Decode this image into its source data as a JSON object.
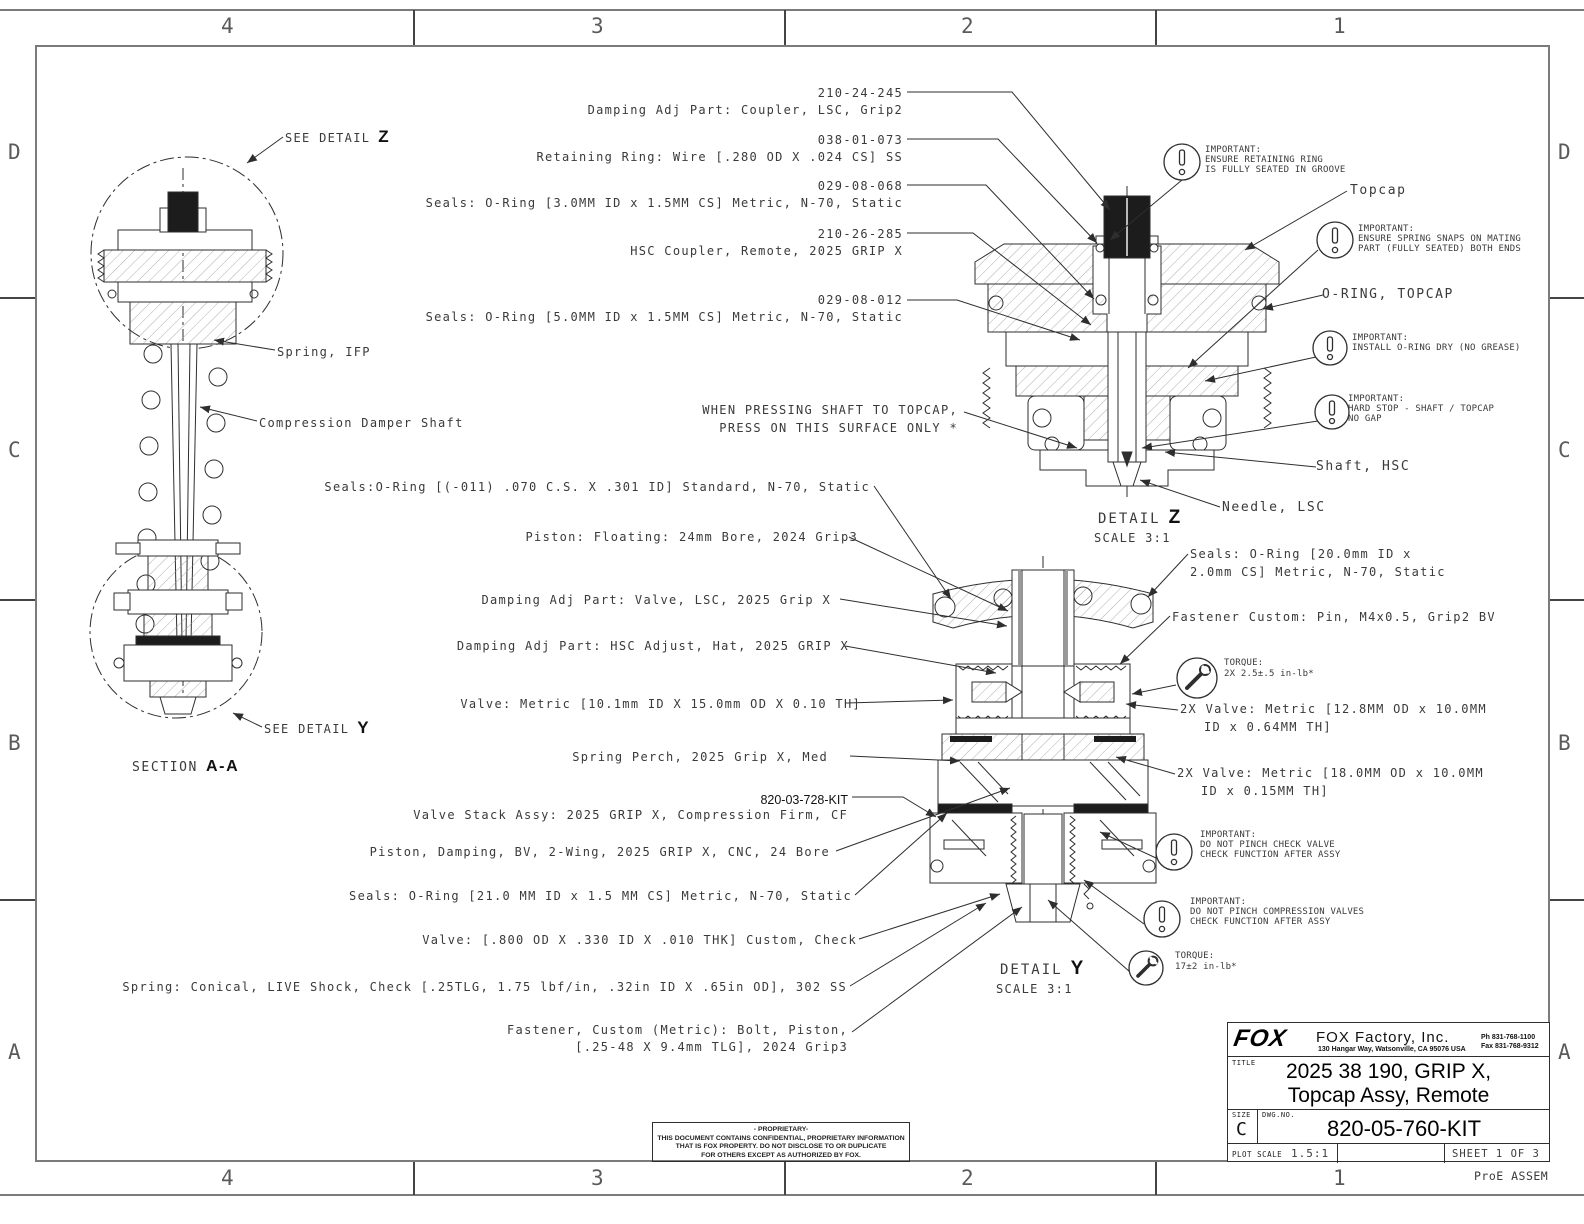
{
  "colors": {
    "line": "#2e2e2e",
    "border": "#7b7b7b",
    "text": "#3a3a3a",
    "dark_fill": "#1c1c1c"
  },
  "border": {
    "h_zones": [
      "4",
      "3",
      "2",
      "1"
    ],
    "v_zones": [
      "D",
      "C",
      "B",
      "A"
    ],
    "corner_note": "ProE ASSEM"
  },
  "section_view": {
    "see_detail": "SEE DETAIL",
    "z": "Z",
    "y": "Y",
    "spring_ifp": "Spring, IFP",
    "damper_shaft": "Compression Damper Shaft",
    "section_word": "SECTION",
    "section_id": "A-A"
  },
  "details": {
    "z": {
      "word": "DETAIL",
      "letter": "Z",
      "scale": "SCALE  3:1"
    },
    "y": {
      "word": "DETAIL",
      "letter": "Y",
      "scale": "SCALE  3:1"
    }
  },
  "part_callouts": [
    {
      "pn": "210-24-245",
      "desc": "Damping Adj Part: Coupler, LSC, Grip2"
    },
    {
      "pn": "038-01-073",
      "desc": "Retaining Ring: Wire [.280 OD X .024 CS] SS"
    },
    {
      "pn": "029-08-068",
      "desc": "Seals: O-Ring [3.0MM ID x 1.5MM CS] Metric, N-70, Static"
    },
    {
      "pn": "210-26-285",
      "desc": "HSC Coupler, Remote, 2025 GRIP X"
    },
    {
      "pn": "029-08-012",
      "desc": "Seals: O-Ring [5.0MM ID x 1.5MM CS] Metric, N-70, Static"
    }
  ],
  "press_note": {
    "line1": "WHEN PRESSING SHAFT TO TOPCAP,",
    "line2": "PRESS ON THIS SURFACE ONLY *"
  },
  "mid_callouts": [
    {
      "desc": "Seals:O-Ring [(-011) .070 C.S. X .301 ID] Standard, N-70, Static"
    },
    {
      "desc": "Piston: Floating: 24mm Bore, 2024 Grip3"
    },
    {
      "desc": "Damping Adj Part: Valve, LSC, 2025 Grip X"
    },
    {
      "desc": "Damping Adj Part: HSC Adjust, Hat, 2025 GRIP X"
    },
    {
      "desc": "Valve: Metric [10.1mm ID X 15.0mm OD X 0.10 TH]"
    },
    {
      "desc": "Spring Perch, 2025 Grip X, Med"
    },
    {
      "pn": "820-03-728-KIT",
      "desc": "Valve Stack Assy: 2025 GRIP X, Compression Firm, CF"
    },
    {
      "desc": "Piston, Damping, BV, 2-Wing, 2025 GRIP X, CNC, 24 Bore"
    },
    {
      "desc": "Seals: O-Ring [21.0 MM ID x 1.5 MM CS] Metric, N-70, Static"
    },
    {
      "desc": "Valve: [.800 OD X .330 ID X .010 THK] Custom, Check"
    },
    {
      "desc": "Spring: Conical, LIVE Shock, Check [.25TLG, 1.75 lbf/in, .32in ID X .65in OD], 302 SS"
    },
    {
      "desc": "Fastener, Custom (Metric): Bolt, Piston,",
      "desc2": "[.25-48 X 9.4mm TLG], 2024 Grip3"
    }
  ],
  "right_callouts": {
    "topcap": "Topcap",
    "oring_topcap": "O-RING, TOPCAP",
    "shaft_hsc": "Shaft, HSC",
    "needle_lsc": "Needle, LSC",
    "seals_20": {
      "line1": "Seals: O-Ring [20.0mm ID x",
      "line2": "2.0mm CS] Metric, N-70, Static"
    },
    "fastener_pin": "Fastener Custom: Pin, M4x0.5, Grip2 BV",
    "valve_12": {
      "line1": "2X Valve: Metric [12.8MM OD x 10.0MM",
      "line2": "ID x 0.64MM TH]"
    },
    "valve_18": {
      "line1": "2X Valve: Metric [18.0MM OD x 10.0MM",
      "line2": "ID x 0.15MM TH]"
    }
  },
  "important_notes": [
    {
      "title": "IMPORTANT:",
      "line1": "ENSURE RETAINING RING",
      "line2": "IS FULLY SEATED IN GROOVE"
    },
    {
      "title": "IMPORTANT:",
      "line1": "ENSURE SPRING SNAPS ON MATING",
      "line2": "PART (FULLY SEATED) BOTH ENDS"
    },
    {
      "title": "IMPORTANT:",
      "line1": "INSTALL O-RING DRY (NO GREASE)",
      "line2": ""
    },
    {
      "title": "IMPORTANT:",
      "line1": "HARD STOP - SHAFT / TOPCAP",
      "line2": "NO GAP"
    },
    {
      "title": "IMPORTANT:",
      "line1": "DO NOT PINCH CHECK VALVE",
      "line2": "CHECK FUNCTION AFTER ASSY"
    },
    {
      "title": "IMPORTANT:",
      "line1": "DO NOT PINCH COMPRESSION VALVES",
      "line2": "CHECK FUNCTION AFTER ASSY"
    }
  ],
  "torque_notes": [
    {
      "title": "TORQUE:",
      "value": "2X 2.5±.5 in-lb*"
    },
    {
      "title": "TORQUE:",
      "value": "17±2 in-lb*"
    }
  ],
  "title_block": {
    "logo": "FOX",
    "company": "FOX Factory, Inc.",
    "address": "130 Hangar Way, Watsonville, CA 95076 USA",
    "phone": "Ph 831-768-1100",
    "fax": "Fax 831-768-9312",
    "title_label": "TITLE",
    "title1": "2025 38 190, GRIP X,",
    "title2": "Topcap Assy, Remote",
    "size_label": "SIZE",
    "size": "C",
    "dwg_label": "DWG.NO.",
    "dwg_no": "820-05-760-KIT",
    "plot_label": "PLOT SCALE",
    "plot_scale": "1.5:1",
    "sheet": "SHEET 1 OF 3"
  },
  "proprietary": {
    "line1": "- PROPRIETARY-",
    "line2": "THIS DOCUMENT CONTAINS CONFIDENTIAL, PROPRIETARY INFORMATION",
    "line3": "THAT IS FOX PROPERTY.  DO NOT DISCLOSE TO OR DUPLICATE",
    "line4": "FOR OTHERS EXCEPT AS AUTHORIZED BY FOX."
  }
}
